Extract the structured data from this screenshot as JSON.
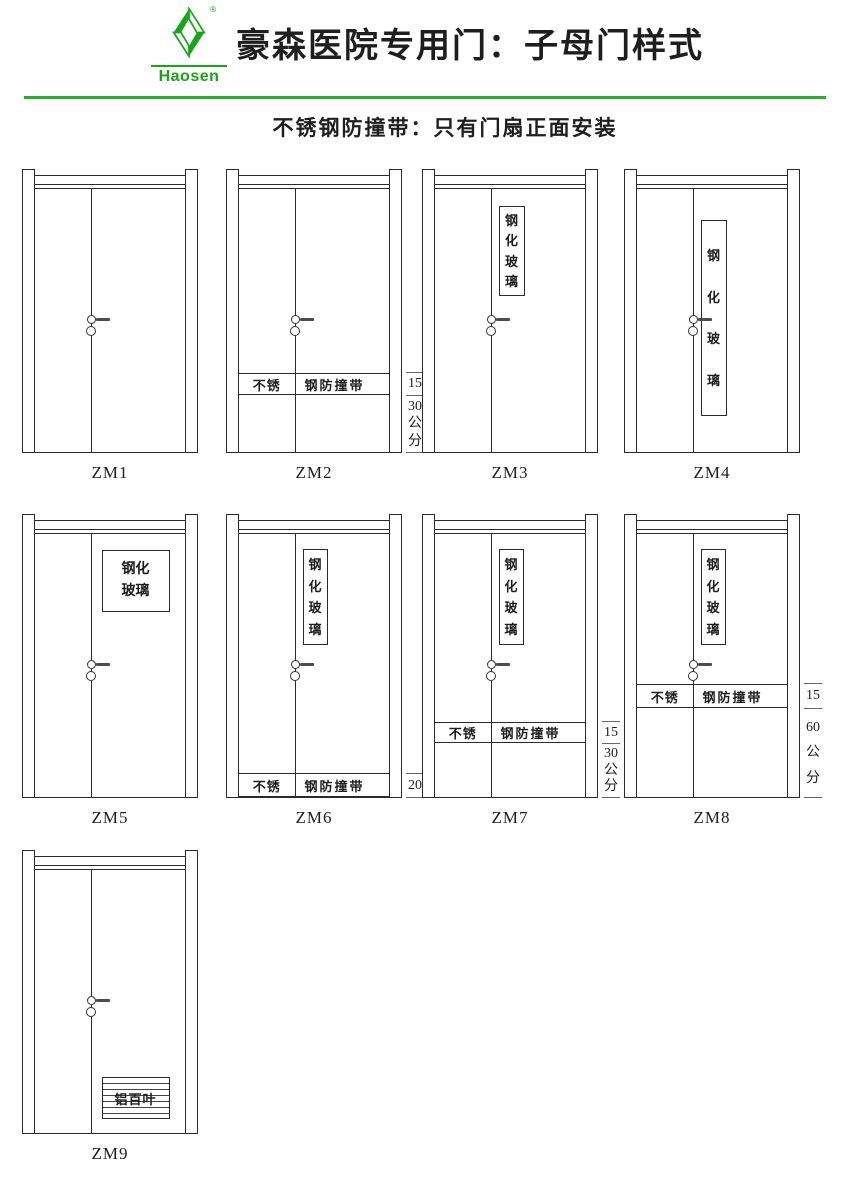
{
  "header": {
    "brand": "Haosen",
    "registered_mark": "®",
    "title": "豪森医院专用门：子母门样式",
    "subtitle": "不锈钢防撞带：只有门扇正面安装",
    "accent_green": "#16a616",
    "rule_green": "#22b422",
    "line_color": "#2b2b2b"
  },
  "doors": [
    {
      "id": "zm1",
      "label": "ZM1"
    },
    {
      "id": "zm2",
      "label": "ZM2",
      "strip_left": "不锈",
      "strip_right": "钢防撞带",
      "dim_band": "15",
      "dim_offset": "30公分"
    },
    {
      "id": "zm3",
      "label": "ZM3",
      "glass": "钢化玻璃"
    },
    {
      "id": "zm4",
      "label": "ZM4",
      "glass": "钢化玻璃"
    },
    {
      "id": "zm5",
      "label": "ZM5",
      "glass": "钢化玻璃"
    },
    {
      "id": "zm6",
      "label": "ZM6",
      "glass": "钢化玻璃",
      "strip_left": "不锈",
      "strip_right": "钢防撞带",
      "dim_band": "20"
    },
    {
      "id": "zm7",
      "label": "ZM7",
      "glass": "钢化玻璃",
      "strip_left": "不锈",
      "strip_right": "钢防撞带",
      "dim_band": "15",
      "dim_offset": "30公分"
    },
    {
      "id": "zm8",
      "label": "ZM8",
      "glass": "钢化玻璃",
      "strip_left": "不锈",
      "strip_right": "钢防撞带",
      "dim_band": "15",
      "dim_offset": "60公分"
    },
    {
      "id": "zm9",
      "label": "ZM9",
      "louver": "铝百叶"
    }
  ]
}
